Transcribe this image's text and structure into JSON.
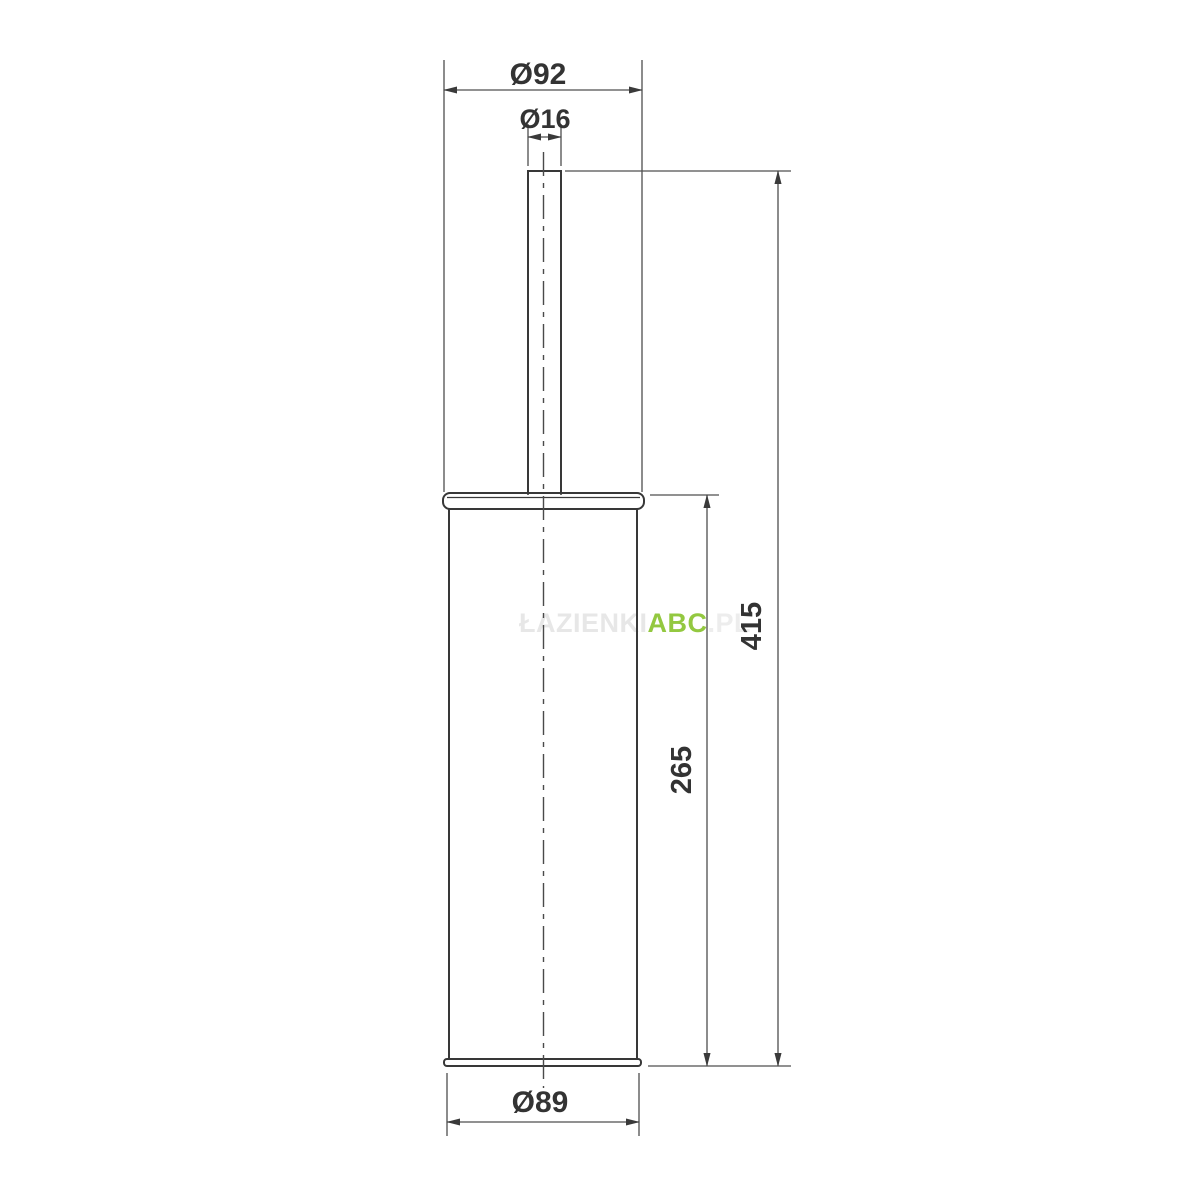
{
  "drawing": {
    "description": "Side-view technical dimension drawing of a cylindrical toilet brush holder with handle",
    "dimensions": {
      "top_diameter": "Ø92",
      "handle_diameter": "Ø16",
      "total_height": "415",
      "body_height": "265",
      "bottom_diameter": "Ø89"
    },
    "colors": {
      "outline": "#383838",
      "dimension_lines": "#4f4f4f",
      "label_text": "#333333",
      "watermark_green": "#93c840",
      "watermark_gray": "#e7e7e7",
      "background": "#ffffff"
    },
    "watermark": {
      "prefix": "ŁAZIENKI",
      "brand": "ABC",
      "suffix": ".PL"
    }
  }
}
